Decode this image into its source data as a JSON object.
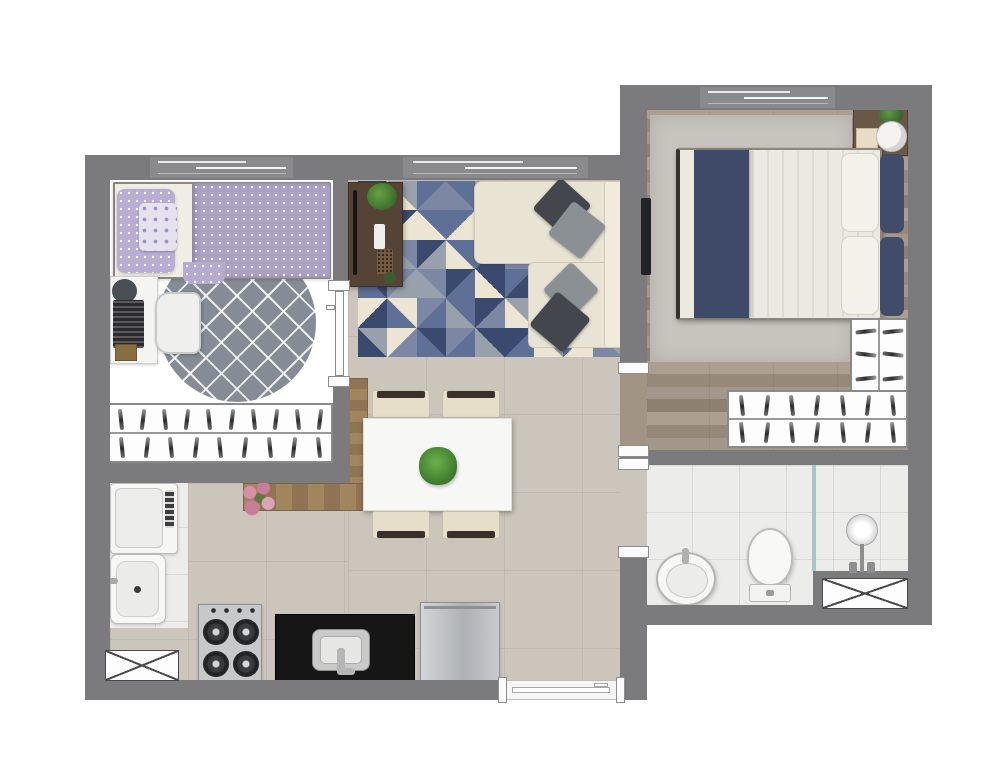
{
  "document": {
    "kind": "residential apartment floor plan, rendered top-down view",
    "background_color": "#ffffff",
    "visible_text": "none"
  },
  "palette": {
    "wall": "#7b7a7c",
    "wood_floor": "#a3968a",
    "hall_tile": "#cbc5bc",
    "bath_tile": "#ececeb",
    "fixture_white": "#fafafa",
    "black_countertop": "#161616",
    "navy": "#3e4a68",
    "lilac": "#aba0c6",
    "sofa_cream": "#e9e3d3",
    "rug_gray": "#858c96",
    "counter_wood": "#9b8160",
    "console_wood": "#554436",
    "fridge_steel": "#b9bcc0",
    "plant_green": "#4e8f3a",
    "flower_pink": "#d590a8",
    "shower_glass": "#a6c8c0"
  },
  "rooms": {
    "bedroom": {
      "name": "Bedroom",
      "furniture": [
        "single bed with lilac polka-dot bedding",
        "desk with laptop",
        "chair",
        "round gray lattice rug",
        "wardrobe with hangers"
      ]
    },
    "living_room": {
      "name": "Living room",
      "furniture": [
        "geometric triangle rug",
        "L-shaped cream sofa with 4 cushions",
        "TV sideboard with plant"
      ]
    },
    "master_bedroom": {
      "name": "Master bedroom",
      "furniture": [
        "double bed with navy runner",
        "nightstand with plant and round tray",
        "wall TV",
        "L-shaped closet with hangers",
        "gray rug"
      ]
    },
    "kitchen_dining": {
      "name": "Kitchen / dining",
      "furniture": [
        "dining table with plant centerpiece",
        "4 chairs",
        "L-shaped wood counter with flower vase",
        "gas stove",
        "black counter with sink",
        "refrigerator"
      ]
    },
    "laundry": {
      "name": "Laundry",
      "furniture": [
        "washing machine",
        "laundry tub",
        "shaft box"
      ]
    },
    "bathroom": {
      "name": "Bathroom",
      "furniture": [
        "round washbasin",
        "toilet",
        "shower with glass partition",
        "shaft box"
      ]
    }
  },
  "windows": {
    "count": 3,
    "locations": [
      "bedroom top wall",
      "living room top wall",
      "master bedroom top wall"
    ]
  },
  "doors": {
    "count": 4,
    "locations": [
      "bedroom door",
      "master bedroom opening",
      "bathroom door",
      "apartment entrance (bottom wall)"
    ]
  },
  "living_rug": {
    "rows": 6,
    "cols": 9,
    "palette": [
      "#3a4a6e",
      "#5f7096",
      "#98a0ab",
      "#ece5d3",
      "#7c88a3"
    ]
  },
  "closets": {
    "bedroom_wardrobe": {
      "rows": [
        10,
        9
      ],
      "vertical": false
    },
    "master_closet_long": {
      "rows": [
        7,
        7
      ],
      "vertical": false
    },
    "master_closet_side": {
      "rows": [
        3,
        3
      ],
      "vertical": true
    }
  },
  "stove": {
    "burners": 4,
    "knobs": 4
  },
  "dining": {
    "chairs": 4
  }
}
